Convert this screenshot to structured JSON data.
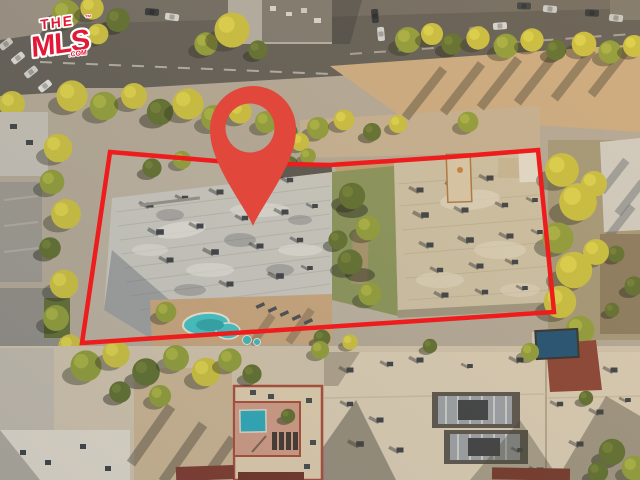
{
  "meta": {
    "width": 640,
    "height": 480,
    "description": "Aerial drone photo of a city block at golden hour: subject apartment buildings outlined in red with a red map location pin, tree-lined street across the top, neighboring rooftops, courtyards and swimming pools below, TheMLS.com watermark in the bottom-right corner."
  },
  "overlay": {
    "boundary": {
      "color": "#ee1c1c",
      "stroke_width": "4.5",
      "points": "110,152 240,163 330,165 450,157 538,150 554,312 82,343"
    },
    "pin": {
      "color": "#e2473c",
      "path": "M253,226 C247,211 222,178 214,152 C211,144 210,136 210,129 A43,43 0 1 1 296,129 C296,136 295,144 292,152 C284,178 259,211 253,226 Z M250,103.5 A24.5,24.5 0 1 0 250,152.5 A24.5,24.5 0 1 0 250,103.5 Z"
    }
  },
  "watermark": {
    "brand_color": "#e31837",
    "line1": "THE",
    "line2": "MLS",
    "suffix": ".COM",
    "trademark": "™"
  }
}
